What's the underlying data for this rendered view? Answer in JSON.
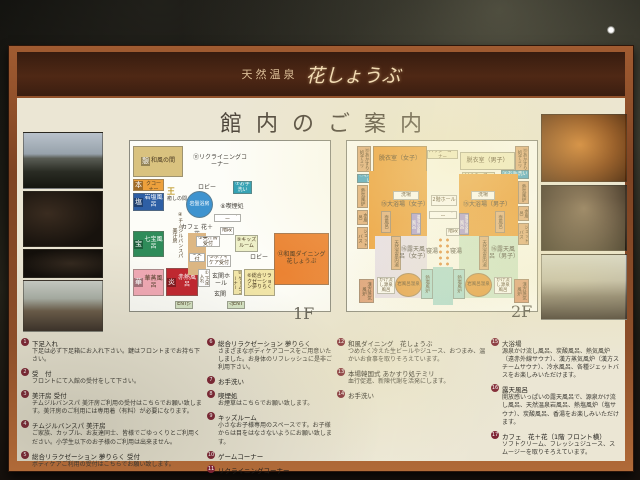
{
  "header": {
    "brand_prefix": "天然温泉",
    "brand_name": "花しょうぶ"
  },
  "title": "館内のご案内",
  "floors": {
    "f1_label": "1F",
    "f2_label": "2F"
  },
  "floor1": {
    "icons": {
      "ikoi": "憩",
      "hon": "本",
      "shio": "塩",
      "ou": "王",
      "takara": "宝",
      "hana": "華",
      "honoo": "炎"
    },
    "rooms": {
      "washitsu": "和風の間",
      "comic": "コミックコーナー",
      "ganen": "岩塩風呂",
      "iyashi": "癒しの間",
      "ganban": "岩盤浴房",
      "shippo": "七宝風呂",
      "kasho": "華蒸風呂",
      "sekinetsu": "赤熱風呂",
      "recline": "⑪リクライニングコーナー",
      "lobby1": "ロビー",
      "lobby2": "ロビー",
      "toilet": "⑦お手洗い",
      "chimu": "④チムジルバンスパ美汗房",
      "cafe": "カフェ 花＋花",
      "elev": "エレベーター",
      "smoke": "⑧喫煙処",
      "stairs": "階段",
      "kids": "⑨キッズルーム",
      "bikan_uke": "③美汗房受付",
      "uke": "②受付",
      "body": "⑤ボディケア受付",
      "game": "⑩ゲームコーナー",
      "yume": "⑥総合リラクゼーション夢りらく",
      "dining": "⑫和風ダイニング花しょうぶ",
      "gesoku": "①下足入れ",
      "hall": "玄関ホール",
      "genkan": "玄関",
      "ent_l": "ENT▷",
      "ent_r": "◁ENT"
    }
  },
  "floor2": {
    "rooms": {
      "temiri": "⑬あかすり処テミリ",
      "datsui_f": "脱衣室（女子）",
      "datsui_m": "脱衣室（男子）",
      "powder": "パウダーコーナー",
      "toilet": "⑭お手洗い",
      "nekki": "熱気風炉",
      "araiba": "洗場",
      "daiyoku_f": "⑮大浴場（女子）",
      "daiyoku_m": "⑮大浴場（男子）",
      "mizu": "水風呂",
      "jet": "ジェットバス",
      "hall": "2階ホール",
      "elev": "エレベーター",
      "stairs": "階段",
      "tsubo": "壺風呂",
      "rotensan": "露天炭酸風呂",
      "uchiyu": "天然温泉内湯",
      "roten_f": "⑯露天風呂（女子）",
      "roten_m": "⑯露天風呂（男子）",
      "neyu": "寝湯",
      "shioburo": "熱塩風炉",
      "iwa": "岩風呂温泉",
      "kake": "かけ流し源泉風呂",
      "kanpo": "漢方蒸気風炉"
    }
  },
  "legend": {
    "c1": [
      {
        "n": "1",
        "t": "下足入れ",
        "d": "下足は必ず下足箱にお入れ下さい。鍵はフロントまでお持ち下さい。"
      },
      {
        "n": "2",
        "t": "受　付",
        "d": "フロントにて入館の受付をして下さい。"
      },
      {
        "n": "3",
        "t": "美汗房 受付",
        "d": "チムジルバンスパ 美汗房ご利用の受付はこちらでお願い致します。美汗房のご利用には専用着（有料）が必要になります。"
      },
      {
        "n": "4",
        "t": "チムジルバンスパ 美汗房",
        "d": "ご家族、カップル、お友達同士、皆様でごゆっくりとご利用ください。小学生以下のお子様のご利用は出来ません。"
      },
      {
        "n": "5",
        "t": "総合リラクゼーション 夢りらく 受付",
        "d": "ボディケアご利用の受付はこちらでお願い致します。"
      }
    ],
    "c2": [
      {
        "n": "6",
        "t": "総合リラクゼーション 夢りらく",
        "d": "さまざまなボディケアコースをご用意いたしました。お身体のリフレッシュに是非ご利用下さい。"
      },
      {
        "n": "7",
        "t": "お手洗い",
        "d": ""
      },
      {
        "n": "8",
        "t": "喫煙処",
        "d": "お煙草はこちらでお願い致します。"
      },
      {
        "n": "9",
        "t": "キッズルーム",
        "d": "小さなお子様専用のスペースです。お子様からは目をはなさないようにお願い致します。"
      },
      {
        "n": "10",
        "t": "ゲームコーナー",
        "d": ""
      },
      {
        "n": "11",
        "t": "リクライニングコーナー",
        "d": ""
      }
    ],
    "c3": [
      {
        "n": "12",
        "t": "和風ダイニング　花しょうぶ",
        "d": "つめたく冷えた生ビールやジュース、おつまみ、温かいお食事を取りそろえています。"
      },
      {
        "n": "13",
        "t": "本場韓国式 あかすり処テミリ",
        "d": "血行促進、新陳代謝を活発にします。"
      },
      {
        "n": "14",
        "t": "お手洗い",
        "d": ""
      }
    ],
    "c4": [
      {
        "n": "15",
        "t": "大浴場",
        "d": "源泉かけ流し風呂、炭酸風呂、熱気風炉（遠赤外線サウナ）、漢方蒸気風炉（漢方スチームサウナ）、冷水風呂、各種ジェットバスをお楽しみいただけます。"
      },
      {
        "n": "16",
        "t": "露天風呂",
        "d": "開放感いっぱいの露天風呂で、源泉かけ流し風呂、天然温泉岩風呂、熱塩風炉（塩サウナ）、炭酸風呂、香湯をお楽しみいただけます。"
      },
      {
        "n": "17",
        "t": "カフェ　花＋花（1階 フロント横）",
        "d": "ソフトクリーム、フレッシュジュース、スムージーを取りそろえています。"
      }
    ]
  }
}
